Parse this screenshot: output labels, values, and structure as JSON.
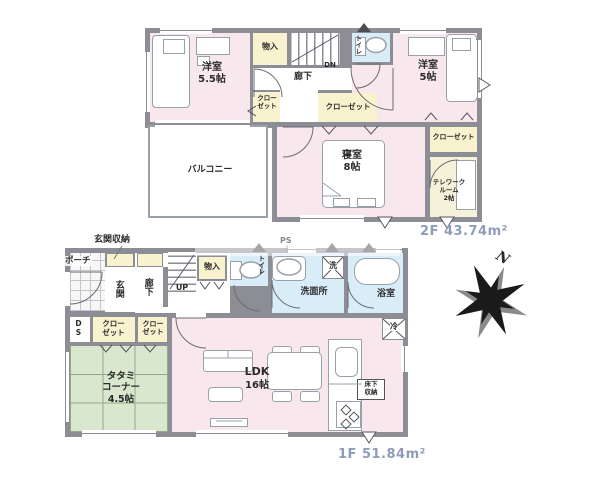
{
  "floor2": {
    "area": "2F 43.74m²",
    "western_room_a": {
      "name": "洋室",
      "size": "5.5帖"
    },
    "western_room_b": {
      "name": "洋室",
      "size": "5帖"
    },
    "bedroom": {
      "name": "寝室",
      "size": "8帖"
    },
    "telework_room": {
      "line1": "テレワーク",
      "line2": "ルーム",
      "line3": "2帖"
    },
    "balcony": "バルコニー",
    "hallway": "廊下",
    "toilet": "トイレ",
    "storage": "物入",
    "closet_small": "クローゼット",
    "closet_wide": "クローゼット",
    "closet_right": "クローゼット",
    "stairs_dn": "DN"
  },
  "floor1": {
    "area": "1F 51.84m²",
    "porch": "ポーチ",
    "entrance_storage": "玄関収納",
    "entrance": "玄関",
    "hallway": "廊下",
    "stairs_up": "UP",
    "storage": "物入",
    "toilet": "トイレ",
    "ps": "PS",
    "washroom": "洗面所",
    "washer": "洗",
    "bathroom": "浴室",
    "fridge": "冷",
    "ds": "DS",
    "closet_a": "クローゼット",
    "closet_b": "クローゼット",
    "tatami_corner": {
      "line1": "タタミ",
      "line2": "コーナー",
      "line3": "4.5帖"
    },
    "ldk": {
      "name": "LDK",
      "size": "16帖"
    },
    "underfloor_storage": "床下収納"
  },
  "compass": {
    "north": "N"
  }
}
